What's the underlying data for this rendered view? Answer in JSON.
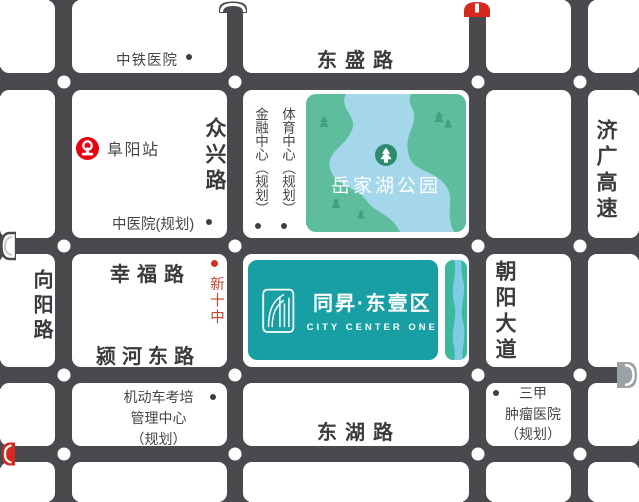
{
  "logo": {
    "name_cn": "同昇·东壹区",
    "name_en": "CITY CENTER ONE"
  },
  "park": {
    "name": "岳家湖公园"
  },
  "roads": {
    "dongsheng": "东盛路",
    "xingfu": "幸福路",
    "yinghe_dong": "颍河东路",
    "donghu": "东湖路",
    "xiangyang": "向阳路",
    "zhongxing": "众兴路",
    "chaoyang": "朝阳大道",
    "jiguang": "济广高速"
  },
  "pois": {
    "zhongtie_hospital": "中铁医院",
    "fuyang_station": "阜阳站",
    "financial_center": "金融中心（规划）",
    "sports_center": "体育中心（规划）",
    "tcm_hospital": "中医院(规划)",
    "xin_shizhong": "新十中",
    "vehicle_center": {
      "line1": "机动车考培",
      "line2": "管理中心",
      "line3": "（规划）"
    },
    "tumor_hospital": {
      "line1": "三甲",
      "line2": "肿瘤医院",
      "line3": "（规划）"
    }
  },
  "icons": {
    "railway_logo": "china-railway-emblem red circle",
    "toll_gate_dark": "dark arch gate, top of 众兴路",
    "toll_gate_red_top": "red arch gate, top of 朝阳大道",
    "toll_gate_light_left": "light arch gate, left end of 幸福路",
    "toll_gate_red_left": "red arch gate, left end of 东湖路",
    "toll_gate_gray_right": "gray arch gate, right end of 颍河东路",
    "park_tree": "white pine tree in dark-green circle"
  },
  "colors": {
    "road": "#4a4a4e",
    "brand_teal": "#189fa4",
    "park_green": "#5ebd9d",
    "lake_blue": "#a4d7e9",
    "gate_red": "#d6281f",
    "poi_red": "#c4482e"
  }
}
